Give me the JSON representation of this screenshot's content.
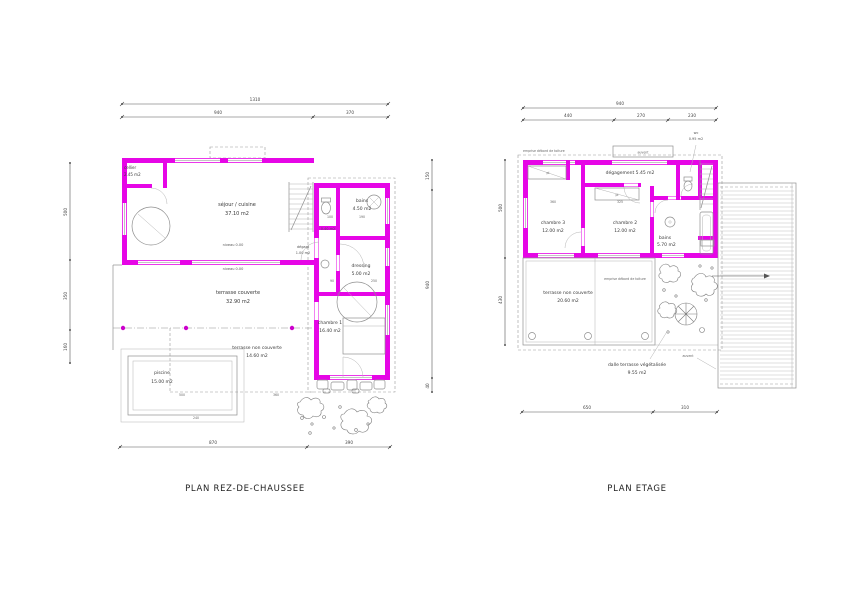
{
  "meta": {
    "background": "#ffffff"
  },
  "colors": {
    "wall": "#e606e6",
    "dot": "#cc00cc",
    "line": "#8a8a8a",
    "dim": "#555555"
  },
  "ground": {
    "title": "PLAN REZ-DE-CHAUSSEE",
    "dims": {
      "total_width": "1310",
      "width_main": "940",
      "width_right": "370",
      "bottom_left": "870",
      "bottom_right": "390",
      "left_top": "500",
      "left_mid": "350",
      "left_bottom": "160",
      "right_top": "150",
      "right_mid": "940",
      "right_bottom": "40",
      "pool_width": "500",
      "terrace_width": "360",
      "pool_outer": "240",
      "int_1": "100",
      "int_2": "190",
      "int_3": "250",
      "int_4": "90"
    },
    "rooms": {
      "cellier": {
        "name": "cellier",
        "area": "2.45 m2"
      },
      "sejour": {
        "name": "séjour / cuisine",
        "area": "37.10 m2"
      },
      "bains": {
        "name": "bains",
        "area": "4.50 m2"
      },
      "dressing": {
        "name": "dressing",
        "area": "5.00 m2"
      },
      "chambre1": {
        "name": "chambre 1",
        "area": "16.40 m2"
      },
      "terrasse_couverte": {
        "name": "terrasse couverte",
        "area": "32.90 m2"
      },
      "terrasse_non_couverte": {
        "name": "terrasse non couverte",
        "area": "14.60 m2"
      },
      "piscine": {
        "name": "piscine",
        "area": "15.00 m2"
      },
      "degagt": {
        "name": "dégagt",
        "area": "1.00 m2"
      },
      "sous_escalier": {
        "area": "0.40 m2"
      }
    },
    "notes": {
      "niveau_1": "niveau 0.00",
      "niveau_2": "niveau 0.00"
    }
  },
  "etage": {
    "title": "PLAN ETAGE",
    "dims": {
      "total_width": "940",
      "w1": "440",
      "w2": "270",
      "w3": "230",
      "bottom_left": "650",
      "bottom_right": "310",
      "left_top": "500",
      "left_bottom": "430",
      "int_1": "360",
      "int_2": "325"
    },
    "rooms": {
      "degagement": {
        "label": "dégagement 5.45 m2"
      },
      "chambre3": {
        "name": "chambre 3",
        "area": "12.00 m2"
      },
      "chambre2": {
        "name": "chambre 2",
        "area": "12.00 m2"
      },
      "bains": {
        "name": "bains",
        "area": "5.70 m2"
      },
      "wc": {
        "name": "wc",
        "area": "0.95 m2"
      },
      "terrasse": {
        "name": "terrasse non couverte",
        "area": "20.60 m2"
      },
      "dalle": {
        "name": "dalle terrasse végétalisée",
        "area": "9.55 m2"
      }
    },
    "labels": {
      "emprise_top": "emprise débord de toiture",
      "emprise_mid": "emprise débord de toiture",
      "auvent_top": "auvent",
      "auvent_side": "auvent",
      "pl_1": "pl",
      "pl_2": "pl"
    }
  }
}
